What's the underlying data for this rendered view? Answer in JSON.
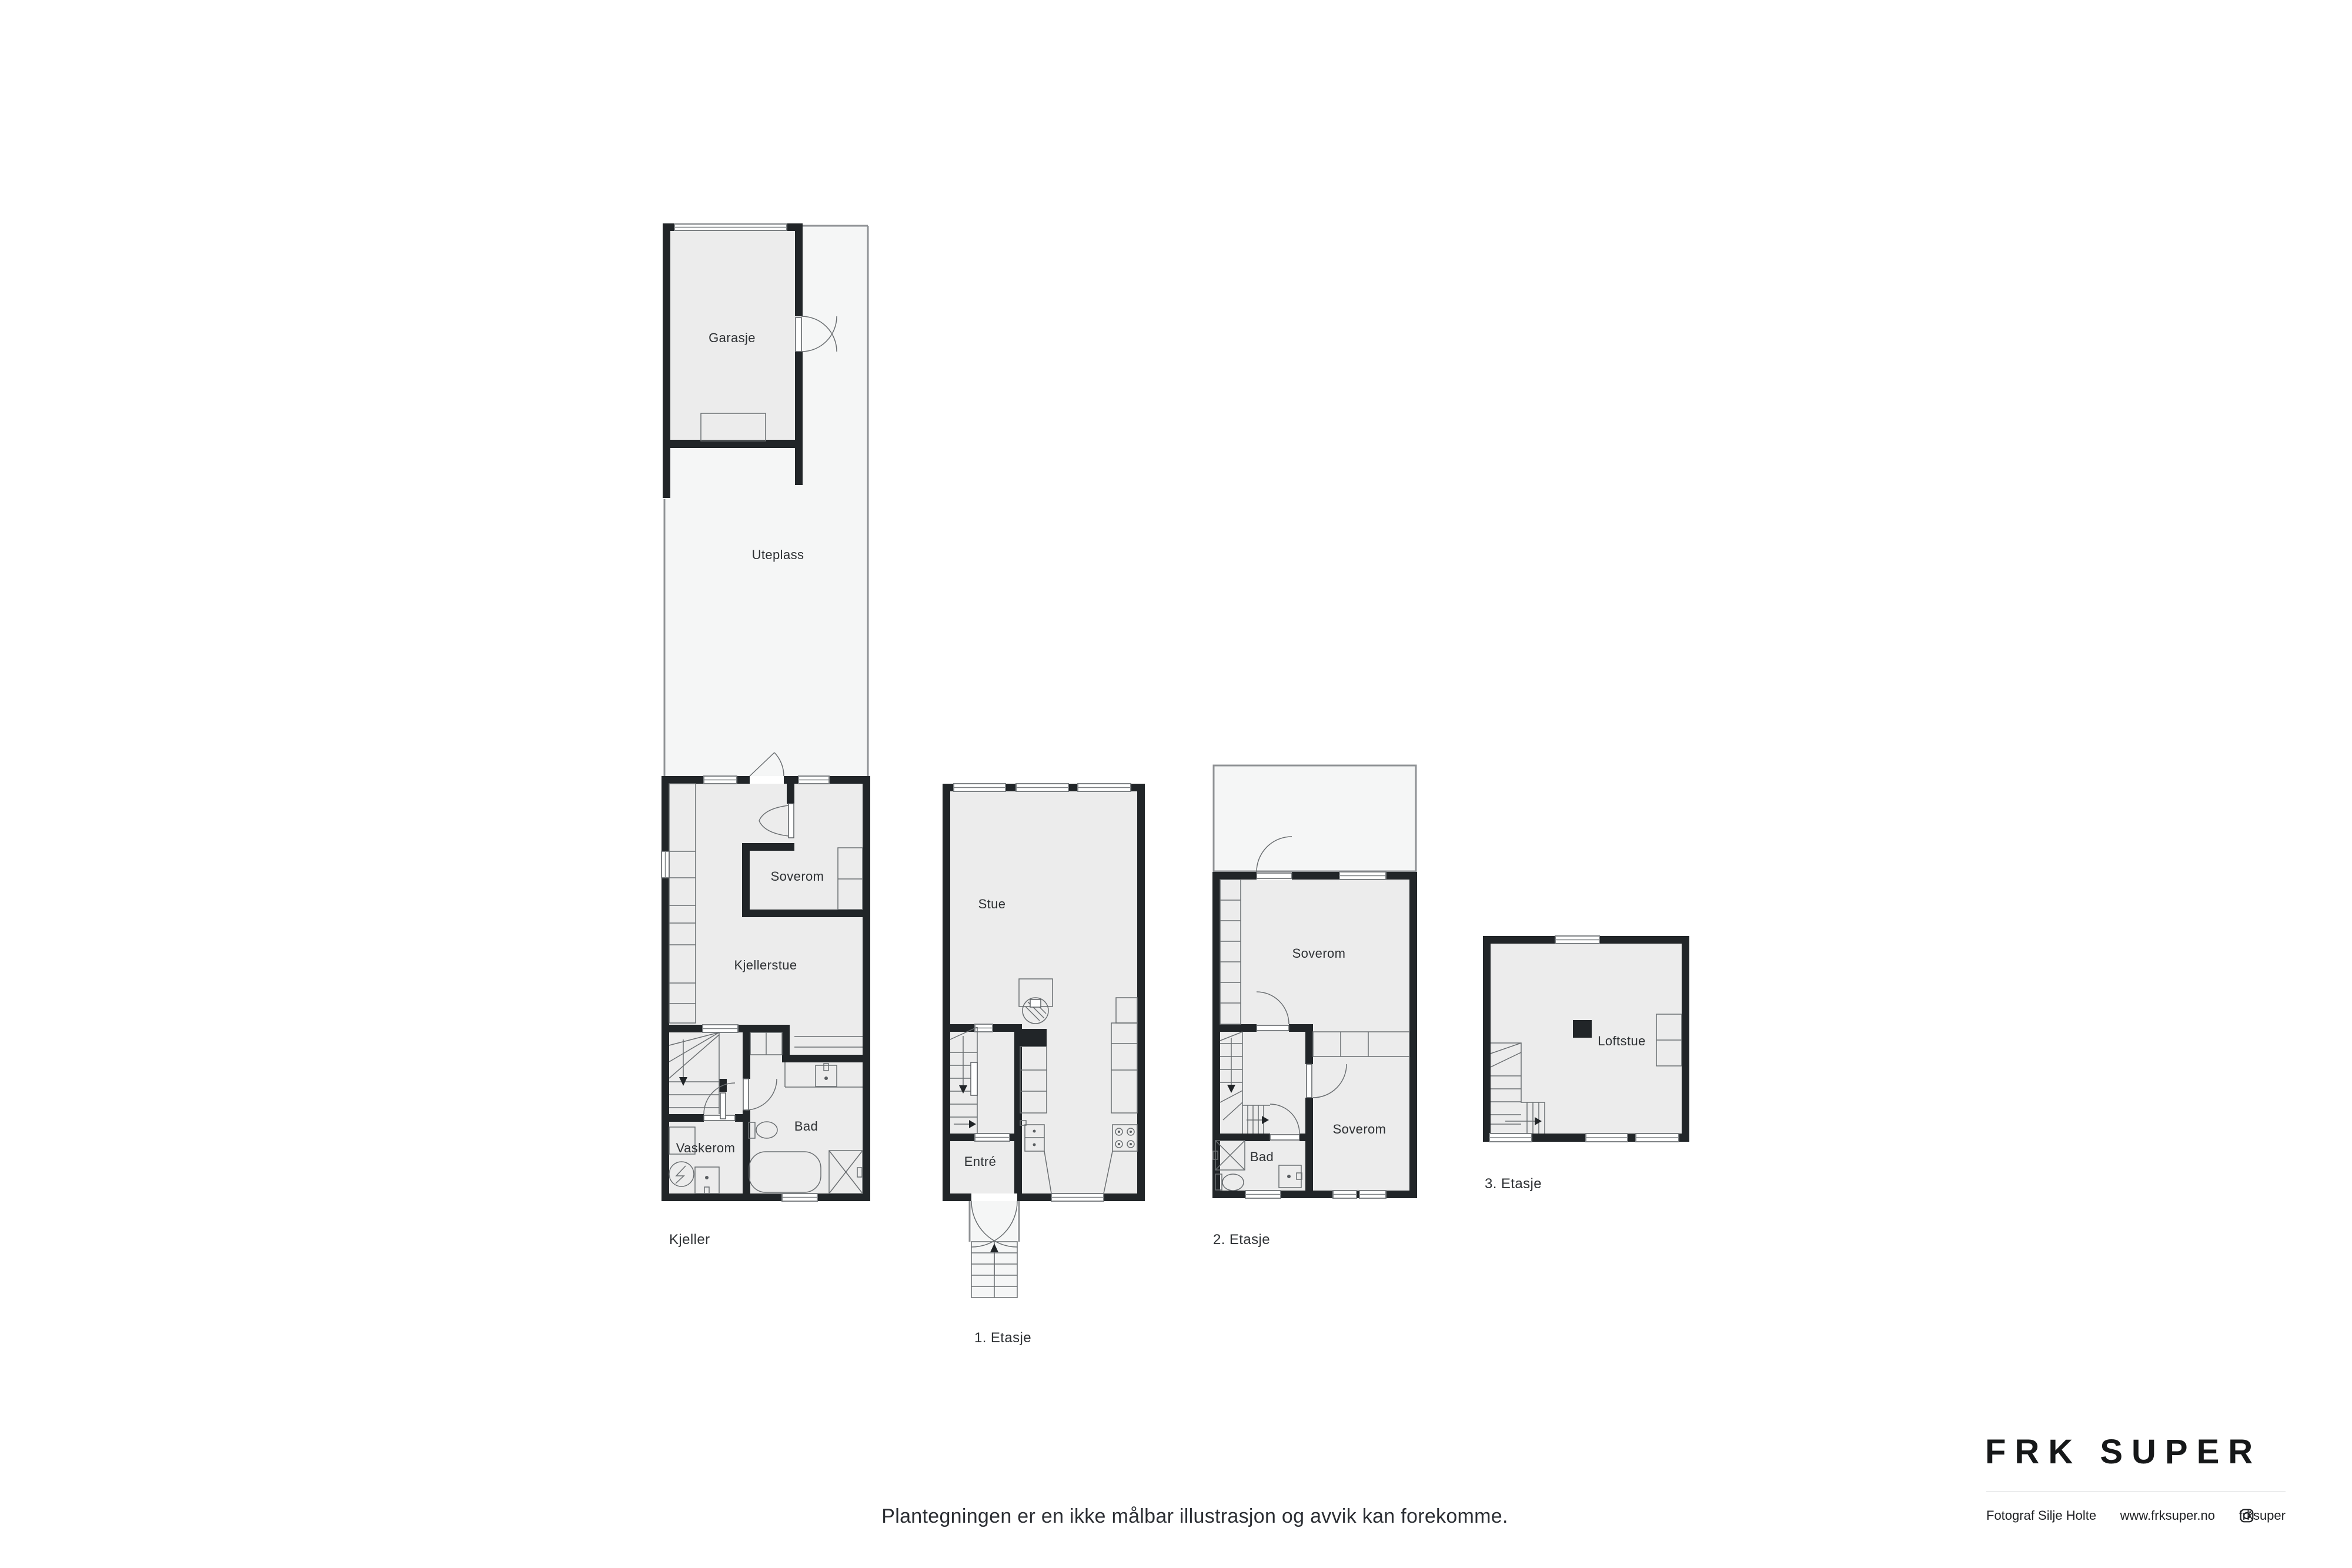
{
  "colors": {
    "wall": "#212528",
    "room_fill": "#ececec",
    "outdoor_fill": "#f5f6f6",
    "furniture_line": "#595d60",
    "outdoor_line": "#8f9295",
    "text": "#2e3134"
  },
  "plans": {
    "kjeller": {
      "floor_label": "Kjeller",
      "rooms": {
        "garasje": "Garasje",
        "uteplass": "Uteplass",
        "soverom": "Soverom",
        "kjellerstue": "Kjellerstue",
        "bad": "Bad",
        "vaskerom": "Vaskerom"
      }
    },
    "etasje1": {
      "floor_label": "1. Etasje",
      "rooms": {
        "stue": "Stue",
        "entre": "Entré"
      }
    },
    "etasje2": {
      "floor_label": "2. Etasje",
      "rooms": {
        "soverom_nord": "Soverom",
        "soverom_sor": "Soverom",
        "bad": "Bad"
      }
    },
    "etasje3": {
      "floor_label": "3. Etasje",
      "rooms": {
        "loftstue": "Loftstue"
      }
    }
  },
  "disclaimer": "Plantegningen er en ikke målbar illustrasjon og avvik kan forekomme.",
  "brand": {
    "logo": "FRK SUPER",
    "photographer": "Fotograf Silje Holte",
    "website": "www.frksuper.no",
    "instagram_handle": "frksuper"
  }
}
